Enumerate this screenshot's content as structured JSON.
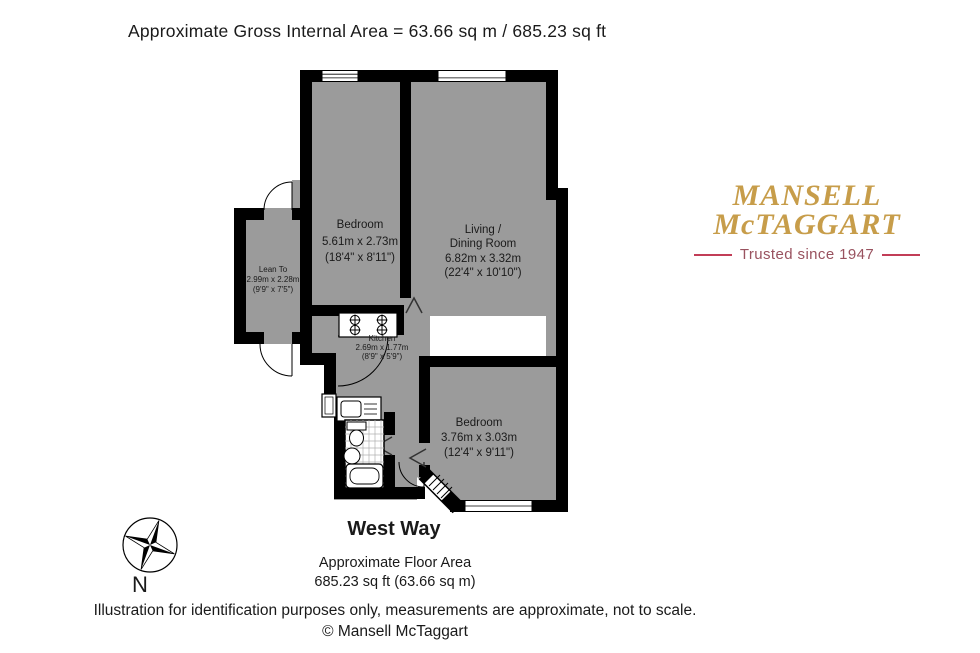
{
  "title": "Approximate Gross Internal Area = 63.66 sq m / 685.23 sq ft",
  "plan": {
    "rooms": {
      "bedroom1": {
        "name": "Bedroom",
        "metric": "5.61m x 2.73m",
        "imperial": "(18'4\" x 8'11\")"
      },
      "living": {
        "name1": "Living /",
        "name2": "Dining Room",
        "metric": "6.82m x 3.32m",
        "imperial": "(22'4\" x 10'10\")"
      },
      "lean_to": {
        "name": "Lean To",
        "metric": "2.99m x 2.28m",
        "imperial": "(9'9\" x 7'5\")"
      },
      "kitchen": {
        "name": "Kitchen",
        "metric": "2.69m x 1.77m",
        "imperial": "(8'9\" x 5'9\")"
      },
      "bedroom2": {
        "name": "Bedroom",
        "metric": "3.76m x 3.03m",
        "imperial": "(12'4\" x 9'11\")"
      }
    },
    "colors": {
      "wall": "#000000",
      "room_fill": "#9b9b9b"
    }
  },
  "street_name": "West Way",
  "floor_area": {
    "label": "Approximate Floor Area",
    "value": "685.23 sq ft (63.66 sq m)"
  },
  "footer": {
    "disclaimer": "Illustration for identification purposes only, measurements are approximate, not to scale.",
    "copyright": "© Mansell McTaggart"
  },
  "logo": {
    "line1": "MANSELL",
    "line2": "McTAGGART",
    "tagline": "Trusted since 1947",
    "colors": {
      "gold": "#c79d4a",
      "rule_red": "#c23d57",
      "tagline_maroon": "#99525f"
    }
  },
  "compass": {
    "label": "N"
  }
}
